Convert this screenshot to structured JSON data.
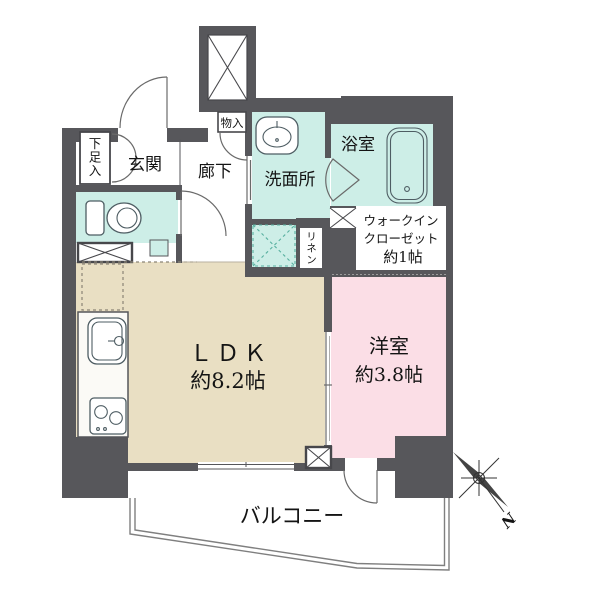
{
  "colors": {
    "wall": "#57575b",
    "wet": "#cdeee7",
    "ldk_floor": "#e9dfc3",
    "bedroom_floor": "#fbdee6",
    "fixture_line": "#4e5d63"
  },
  "labels": {
    "entrance": "玄関",
    "hallway": "廊下",
    "shoe_cabinet": "下足入",
    "storage": "物入",
    "washroom": "洗面所",
    "bathroom": "浴室",
    "linen": "リネン",
    "wic_line1": "ウォークイン",
    "wic_line2": "クローゼット",
    "wic_line3": "約1帖",
    "ldk_name": "ＬＤＫ",
    "ldk_size": "約8.2帖",
    "bedroom_name": "洋室",
    "bedroom_size": "約3.8帖",
    "balcony": "バルコニー",
    "compass_north": "N"
  }
}
